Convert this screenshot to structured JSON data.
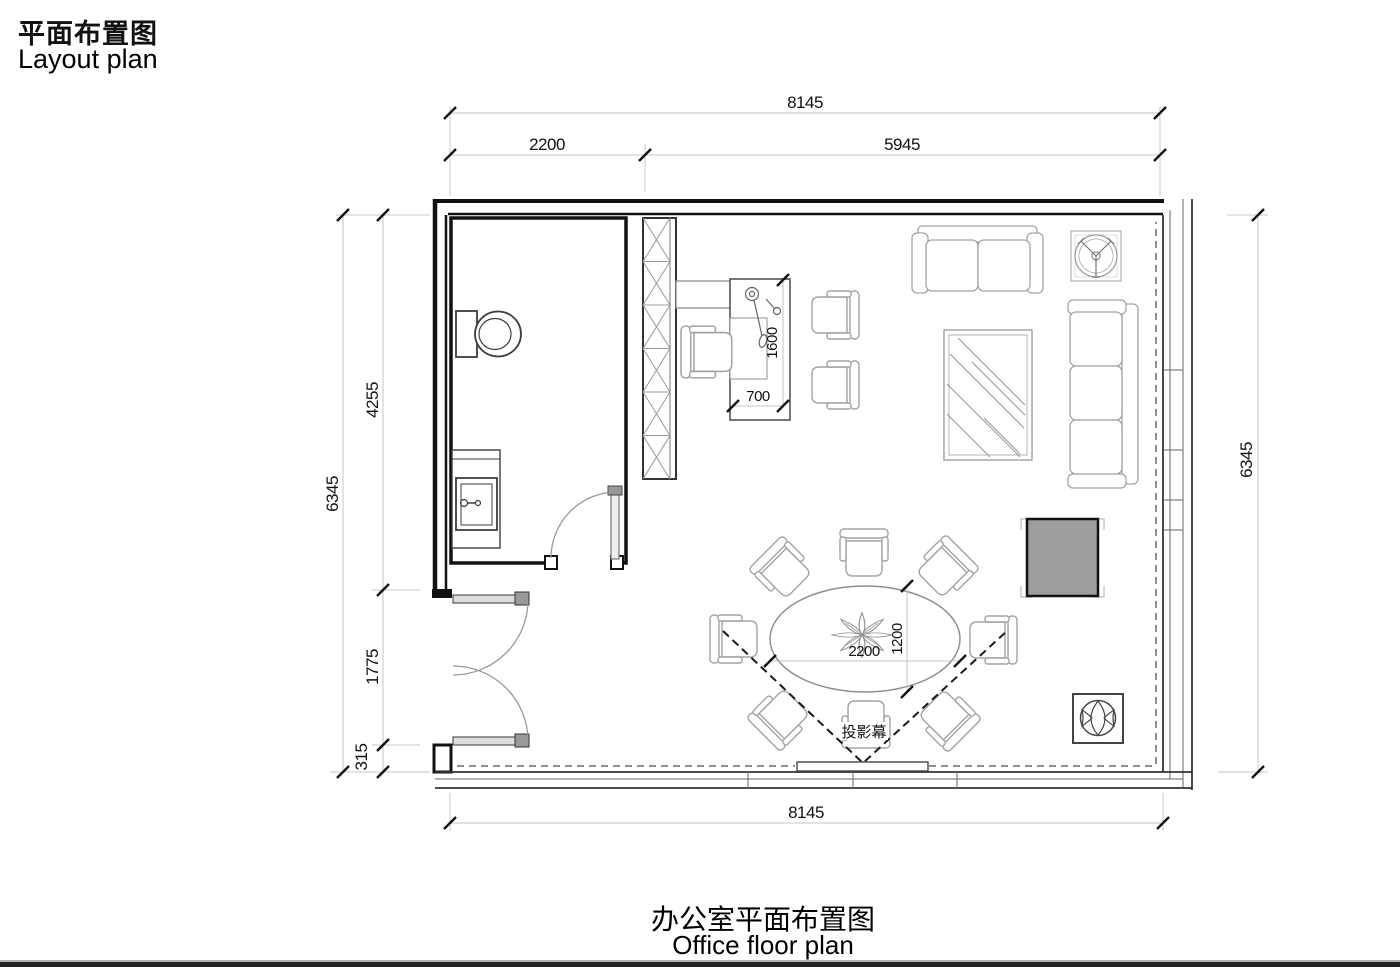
{
  "page": {
    "title_zh": "平面布置图",
    "title_en": "Layout plan",
    "caption_zh": "办公室平面布置图",
    "caption_en": "Office floor plan"
  },
  "dimensions": {
    "top_total": "8145",
    "top_left_segment": "2200",
    "top_right_segment": "5945",
    "left_total": "6345",
    "left_upper_segment": "4255",
    "left_middle_segment": "1775",
    "left_lower_segment": "315",
    "right_total": "6345",
    "bottom_total": "8145",
    "desk_length": "1600",
    "desk_depth": "700",
    "table_length": "2200",
    "table_width": "1200"
  },
  "labels": {
    "projection_screen": "投影幕"
  },
  "colors": {
    "wall_line": "#111111",
    "furniture_line": "#a3a3a3",
    "dimension_line": "#c4c4c4",
    "dimension_text": "#111111",
    "cabinet_fill": "#9e9e9e",
    "dashed_curtain": "#8f8f8f",
    "page_rule": "#222222"
  }
}
